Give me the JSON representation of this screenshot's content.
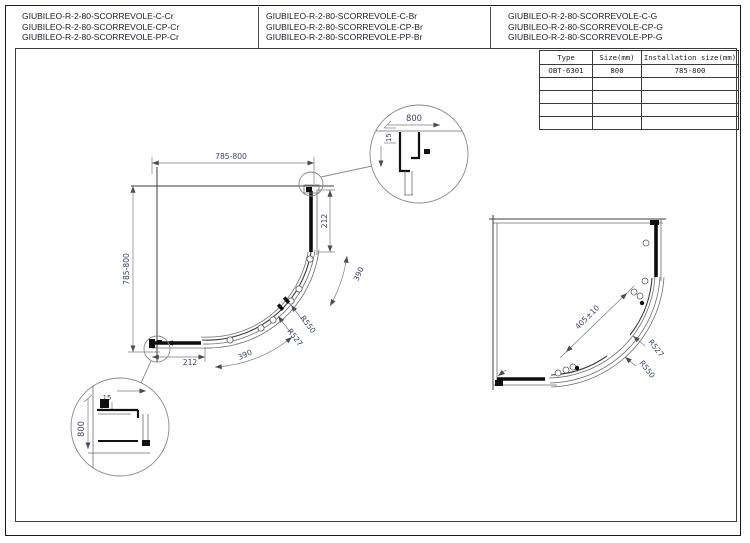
{
  "products": [
    [
      "GIUBILEO-R-2-80-SCORREVOLE-C-Cr",
      "GIUBILEO-R-2-80-SCORREVOLE-CP-Cr",
      "GIUBILEO-R-2-80-SCORREVOLE-PP-Cr"
    ],
    [
      "GIUBILEO-R-2-80-SCORREVOLE-C-Br",
      "GIUBILEO-R-2-80-SCORREVOLE-CP-Br",
      "GIUBILEO-R-2-80-SCORREVOLE-PP-Br"
    ],
    [
      "GIUBILEO-R-2-80-SCORREVOLE-C-G",
      "GIUBILEO-R-2-80-SCORREVOLE-CP-G",
      "GIUBILEO-R-2-80-SCORREVOLE-PP-G"
    ]
  ],
  "spec_table": {
    "headers": [
      "Type",
      "Size(mm)",
      "Installation size(mm)"
    ],
    "rows": [
      [
        "OBT-6301",
        "800",
        "785-800"
      ],
      [
        "",
        "",
        ""
      ],
      [
        "",
        "",
        ""
      ],
      [
        "",
        "",
        ""
      ],
      [
        "",
        "",
        ""
      ]
    ]
  },
  "left_drawing": {
    "top_width": "785-800",
    "left_height": "785-800",
    "fixed_panel_right": "212",
    "fixed_panel_bottom": "212",
    "door_arc_upper": "390",
    "door_arc_lower": "390",
    "radius_outer": "R550",
    "radius_inner": "R527"
  },
  "detail_top_right": {
    "width": "800",
    "profile_depth": "15"
  },
  "detail_bottom_left": {
    "height": "800",
    "profile_depth": "15"
  },
  "right_drawing": {
    "door_opening": "405±10",
    "radius_inner": "R527",
    "radius_outer": "R550"
  },
  "colors": {
    "line": "#1a1a1a",
    "dimension_text": "#3b4663"
  }
}
